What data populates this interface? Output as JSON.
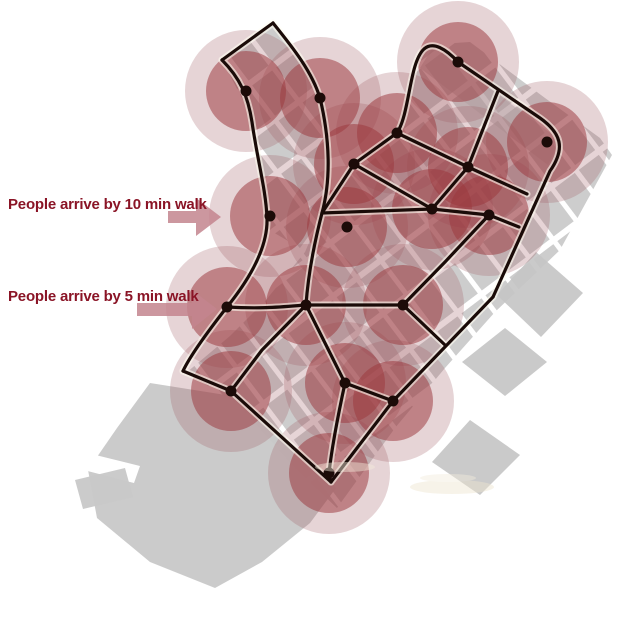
{
  "annotations": {
    "label_10min": "People arrive by 10 min walk",
    "label_5min": "People arrive by 5 min walk"
  },
  "map": {
    "walk_radius_10min_px": 61,
    "walk_radius_5min_px": 40,
    "node_dot_radius_px": 5.5,
    "nodes": [
      [
        246,
        91
      ],
      [
        320,
        98
      ],
      [
        354,
        164
      ],
      [
        397,
        133
      ],
      [
        458,
        62
      ],
      [
        547,
        142
      ],
      [
        468,
        167
      ],
      [
        432,
        209
      ],
      [
        489,
        215
      ],
      [
        270,
        216
      ],
      [
        347,
        227
      ],
      [
        227,
        307
      ],
      [
        306,
        305
      ],
      [
        403,
        305
      ],
      [
        231,
        391
      ],
      [
        345,
        383
      ],
      [
        393,
        401
      ],
      [
        329,
        473
      ]
    ]
  },
  "colors": {
    "circle_5min": "#9b383e",
    "circle_5min_opacity": "0.52",
    "circle_10min": "#9d5a62",
    "circle_10min_opacity": "0.26",
    "street": "#1a0b08",
    "street_casing": "#fffef2",
    "node_dot": "#1c0b08",
    "label_text": "#8a1426",
    "arrow": "#c4858f",
    "base_map_gray": "#c6c6c6"
  }
}
